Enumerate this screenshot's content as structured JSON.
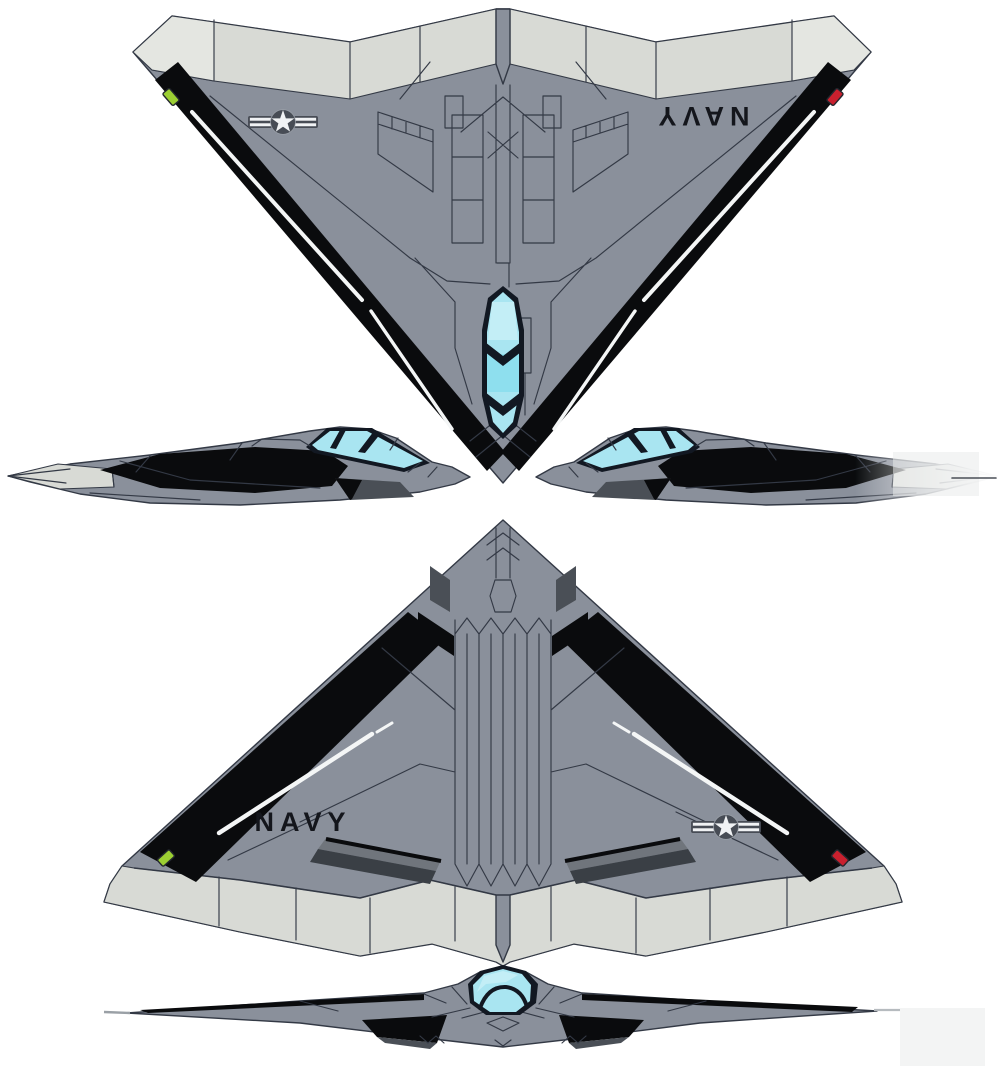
{
  "meta": {
    "background": "#ffffff",
    "description": "Five-view technical illustration of a U.S. Navy stealth flying-wing attack aircraft: top plan view, left and right profile views, bottom plan view and front view"
  },
  "views": {
    "top": {
      "label": "top plan view",
      "marking": "NAVY",
      "marking_orientation": "rotated-180",
      "insignia": "us-star-and-bars-low-visibility",
      "nav_light_left": "green",
      "nav_light_right": "red"
    },
    "side_left": {
      "label": "left profile view",
      "facing": "nose-right"
    },
    "side_right": {
      "label": "right profile view",
      "facing": "nose-left",
      "detail": "tail fades into blur with pitot needle"
    },
    "bottom": {
      "label": "bottom plan view",
      "marking": "NAVY",
      "insignia": "us-star-and-bars-low-visibility",
      "nav_light_left": "green",
      "nav_light_right": "red"
    },
    "front": {
      "label": "front view",
      "detail": "cyan canopy dome, black intakes and leading edges"
    }
  },
  "colors": {
    "page_bg": "#ffffff",
    "body_gray": "#8a909b",
    "body_gray_dark": "#7e8590",
    "panel_line": "#333945",
    "light_gray": "#d8dad5",
    "light_gray_bright": "#e4e6e1",
    "edge_black": "#0a0b0d",
    "stripe_white": "#f4f6f6",
    "canopy_cyan": "#a9e5f1",
    "canopy_cyan_light": "#c3eef6",
    "canopy_cyan_mid": "#8edfee",
    "canopy_frame": "#121822",
    "dark_detail": "#4a4f56",
    "exhaust_top": "#70757c",
    "exhaust_front": "#3a3f45",
    "green_light": "#9ccf33",
    "red_light": "#c9202e",
    "insignia_dark": "#474c55",
    "insignia_star": "#f0f2f4",
    "navy_text": "#14161c"
  }
}
